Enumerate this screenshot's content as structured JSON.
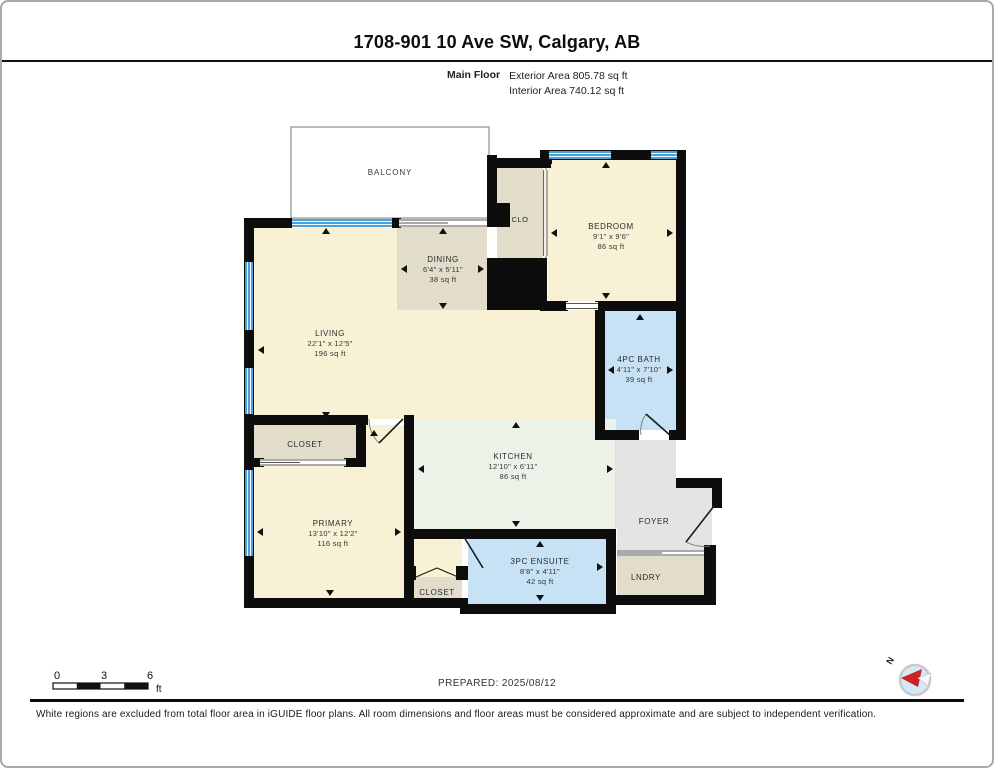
{
  "header": {
    "title": "1708-901 10 Ave SW, Calgary, AB",
    "floor_label": "Main Floor",
    "exterior_area": "Exterior Area 805.78 sq ft",
    "interior_area": "Interior Area 740.12 sq ft"
  },
  "rooms": {
    "balcony": {
      "name": "BALCONY"
    },
    "dining": {
      "name": "DINING",
      "dims": "6'4\" x 5'11\"",
      "area": "38 sq ft"
    },
    "clo": {
      "name": "CLO"
    },
    "bedroom": {
      "name": "BEDROOM",
      "dims": "9'1\" x 9'6\"",
      "area": "86 sq ft"
    },
    "living": {
      "name": "LIVING",
      "dims": "22'1\" x 12'5\"",
      "area": "196 sq ft"
    },
    "bath": {
      "name": "4PC BATH",
      "dims": "4'11\" x 7'10\"",
      "area": "39 sq ft"
    },
    "kitchen": {
      "name": "KITCHEN",
      "dims": "12'10\" x 6'11\"",
      "area": "86 sq ft"
    },
    "closet_upper": {
      "name": "CLOSET"
    },
    "primary": {
      "name": "PRIMARY",
      "dims": "13'10\" x 12'2\"",
      "area": "116 sq ft"
    },
    "ensuite": {
      "name": "3PC ENSUITE",
      "dims": "8'8\" x 4'11\"",
      "area": "42 sq ft"
    },
    "closet_lower": {
      "name": "CLOSET"
    },
    "foyer": {
      "name": "FOYER"
    },
    "lndry": {
      "name": "LNDRY"
    }
  },
  "scale_bar": {
    "tick0": "0",
    "tick3": "3",
    "tick6": "6",
    "unit": "ft"
  },
  "prepared_label": "PREPARED: 2025/08/12",
  "compass": {
    "north_label": "N"
  },
  "footer": {
    "disclaimer": "White regions are excluded from total floor area in iGUIDE floor plans. All room dimensions and floor areas must be considered approximate and are subject to independent verification."
  },
  "colors": {
    "wall": "#0d0d0d",
    "room_cream": "#f9f1d6",
    "room_tan": "#e2dccb",
    "room_blue": "#c6e2f4",
    "room_kitchen": "#edf2e9",
    "room_gray": "#e4e4e2",
    "window_blue": "#4aa0d8",
    "compass_red": "#cc2222"
  }
}
